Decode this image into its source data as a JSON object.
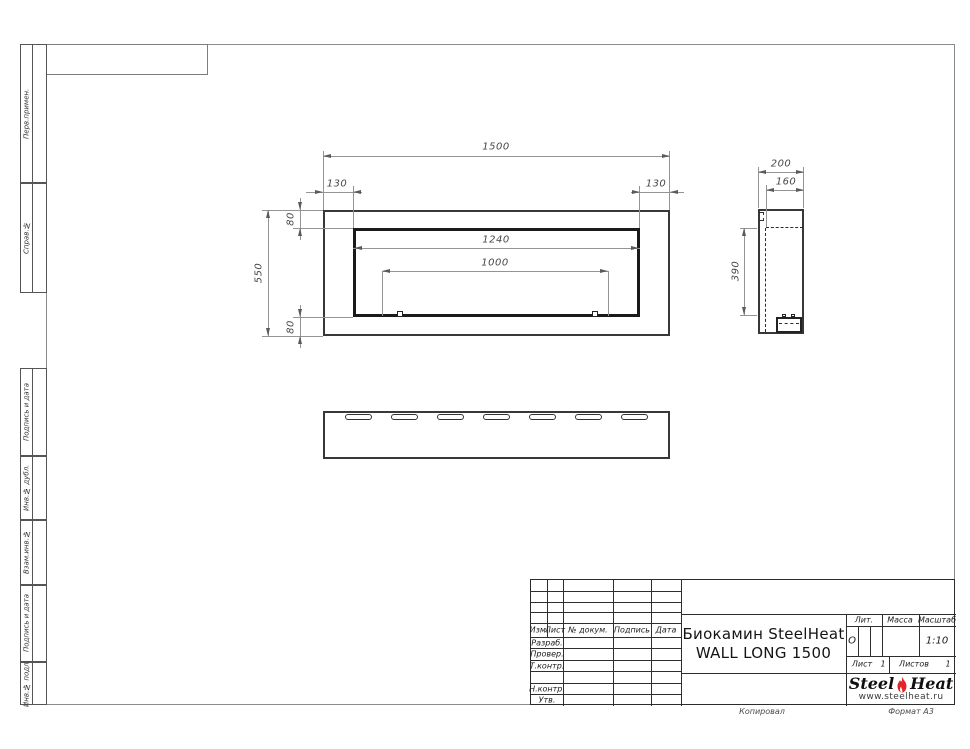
{
  "document_title": "Биокамин SteelHeat WALL LONG 1500",
  "margin_stamps": [
    "Перв.примен.",
    "Справ.№",
    "Подпись и дата",
    "Инв.№ дубл.",
    "Взам.инв.№",
    "Подпись и дата",
    "Инв.№ подл."
  ],
  "dimensions": {
    "front": {
      "overall_width": "1500",
      "left_offset": "130",
      "right_offset": "130",
      "top_offset": "80",
      "overall_height": "550",
      "opening_width": "1240",
      "burner_width": "1000",
      "bottom_offset": "80"
    },
    "side": {
      "depth": "200",
      "inner_depth": "160",
      "inner_height": "390"
    }
  },
  "title_block": {
    "header_cols": [
      "Изм.",
      "Лист",
      "№ докум.",
      "Подпись",
      "Дата"
    ],
    "rows": [
      "Разраб.",
      "Провер.",
      "Т.контр.",
      "",
      "Н.контр.",
      "Утв."
    ],
    "title_line1": "Биокамин SteelHeat",
    "title_line2": "WALL LONG 1500",
    "lit_label": "Лит.",
    "lit_value": "О",
    "mass_label": "Масса",
    "scale_label": "Масштаб",
    "scale_value": "1:10",
    "sheet_label": "Лист",
    "sheet_value": "1",
    "sheets_label": "Листов",
    "sheets_value": "1"
  },
  "logo": {
    "name_part1": "Steel",
    "name_part2": "Heat",
    "website": "www.steelheat.ru",
    "flame_color": "#e2252b"
  },
  "footer": {
    "copy_label": "Копировал",
    "format_label": "Формат А3"
  }
}
